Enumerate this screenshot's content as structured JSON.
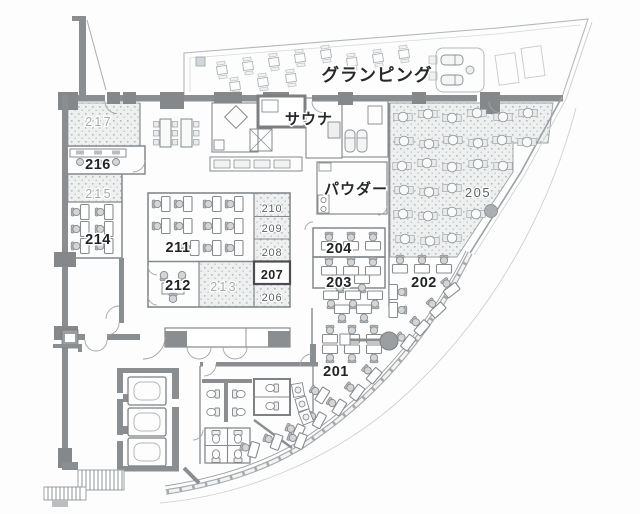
{
  "plan": {
    "area_labels": {
      "glamping": "グランピング",
      "sauna": "サウナ",
      "powder": "パウダー"
    },
    "room_numbers": {
      "r201": "201",
      "r202": "202",
      "r203": "203",
      "r204": "204",
      "r205": "205",
      "r206": "206",
      "r207": "207",
      "r208": "208",
      "r209": "209",
      "r210": "210",
      "r211": "211",
      "r212": "212",
      "r213": "213",
      "r214": "214",
      "r215": "215",
      "r216": "216",
      "r217": "217"
    },
    "colors": {
      "wall": "#8a8e91",
      "wall_dark": "#787c7f",
      "thin_line": "#9aa0a4",
      "stipple_bg": "#edefef",
      "stipple_dot": "#b6babd",
      "label_bold": "#212325",
      "label_light": "#a6aaad",
      "label_mid": "#5d6165"
    }
  }
}
